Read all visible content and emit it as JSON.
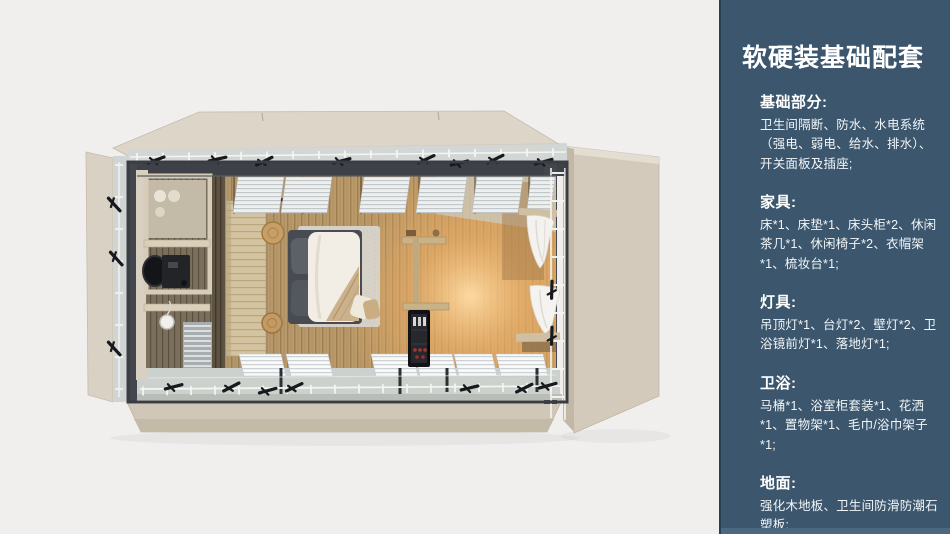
{
  "panel": {
    "title": "软硬装基础配套",
    "sections": [
      {
        "heading": "基础部分:",
        "body": "卫生间隔断、防水、水电系统（强电、弱电、给水、排水）、开关面板及插座;"
      },
      {
        "heading": "家具:",
        "body": "床*1、床垫*1、床头柜*2、休闲茶几*1、休闲椅子*2、衣帽架*1、梳妆台*1;"
      },
      {
        "heading": "灯具:",
        "body": "吊顶灯*1、台灯*2、壁灯*2、卫浴镜前灯*1、落地灯*1;"
      },
      {
        "heading": "卫浴:",
        "body": "马桶*1、浴室柜套装*1、花洒*1、置物架*1、毛巾/浴巾架子*1;"
      },
      {
        "heading": "地面:",
        "body": "强化木地板、卫生间防滑防潮石塑板;"
      }
    ],
    "colors": {
      "panel_background": "#3b566d",
      "panel_footer": "#4a6880",
      "panel_border": "#27404f",
      "text": "#ffffff"
    }
  },
  "floorplan": {
    "colors": {
      "page_background": "#f0efee",
      "shell_beige": "#dcd5c8",
      "steel_frame": "#3e4248",
      "wood_floor": "#b89d72",
      "bathroom_floor": "#7b6e5a",
      "lamp_glow": "#ffdda6",
      "bedding": "#f2eee5",
      "glass": "#d2d7d5"
    }
  }
}
